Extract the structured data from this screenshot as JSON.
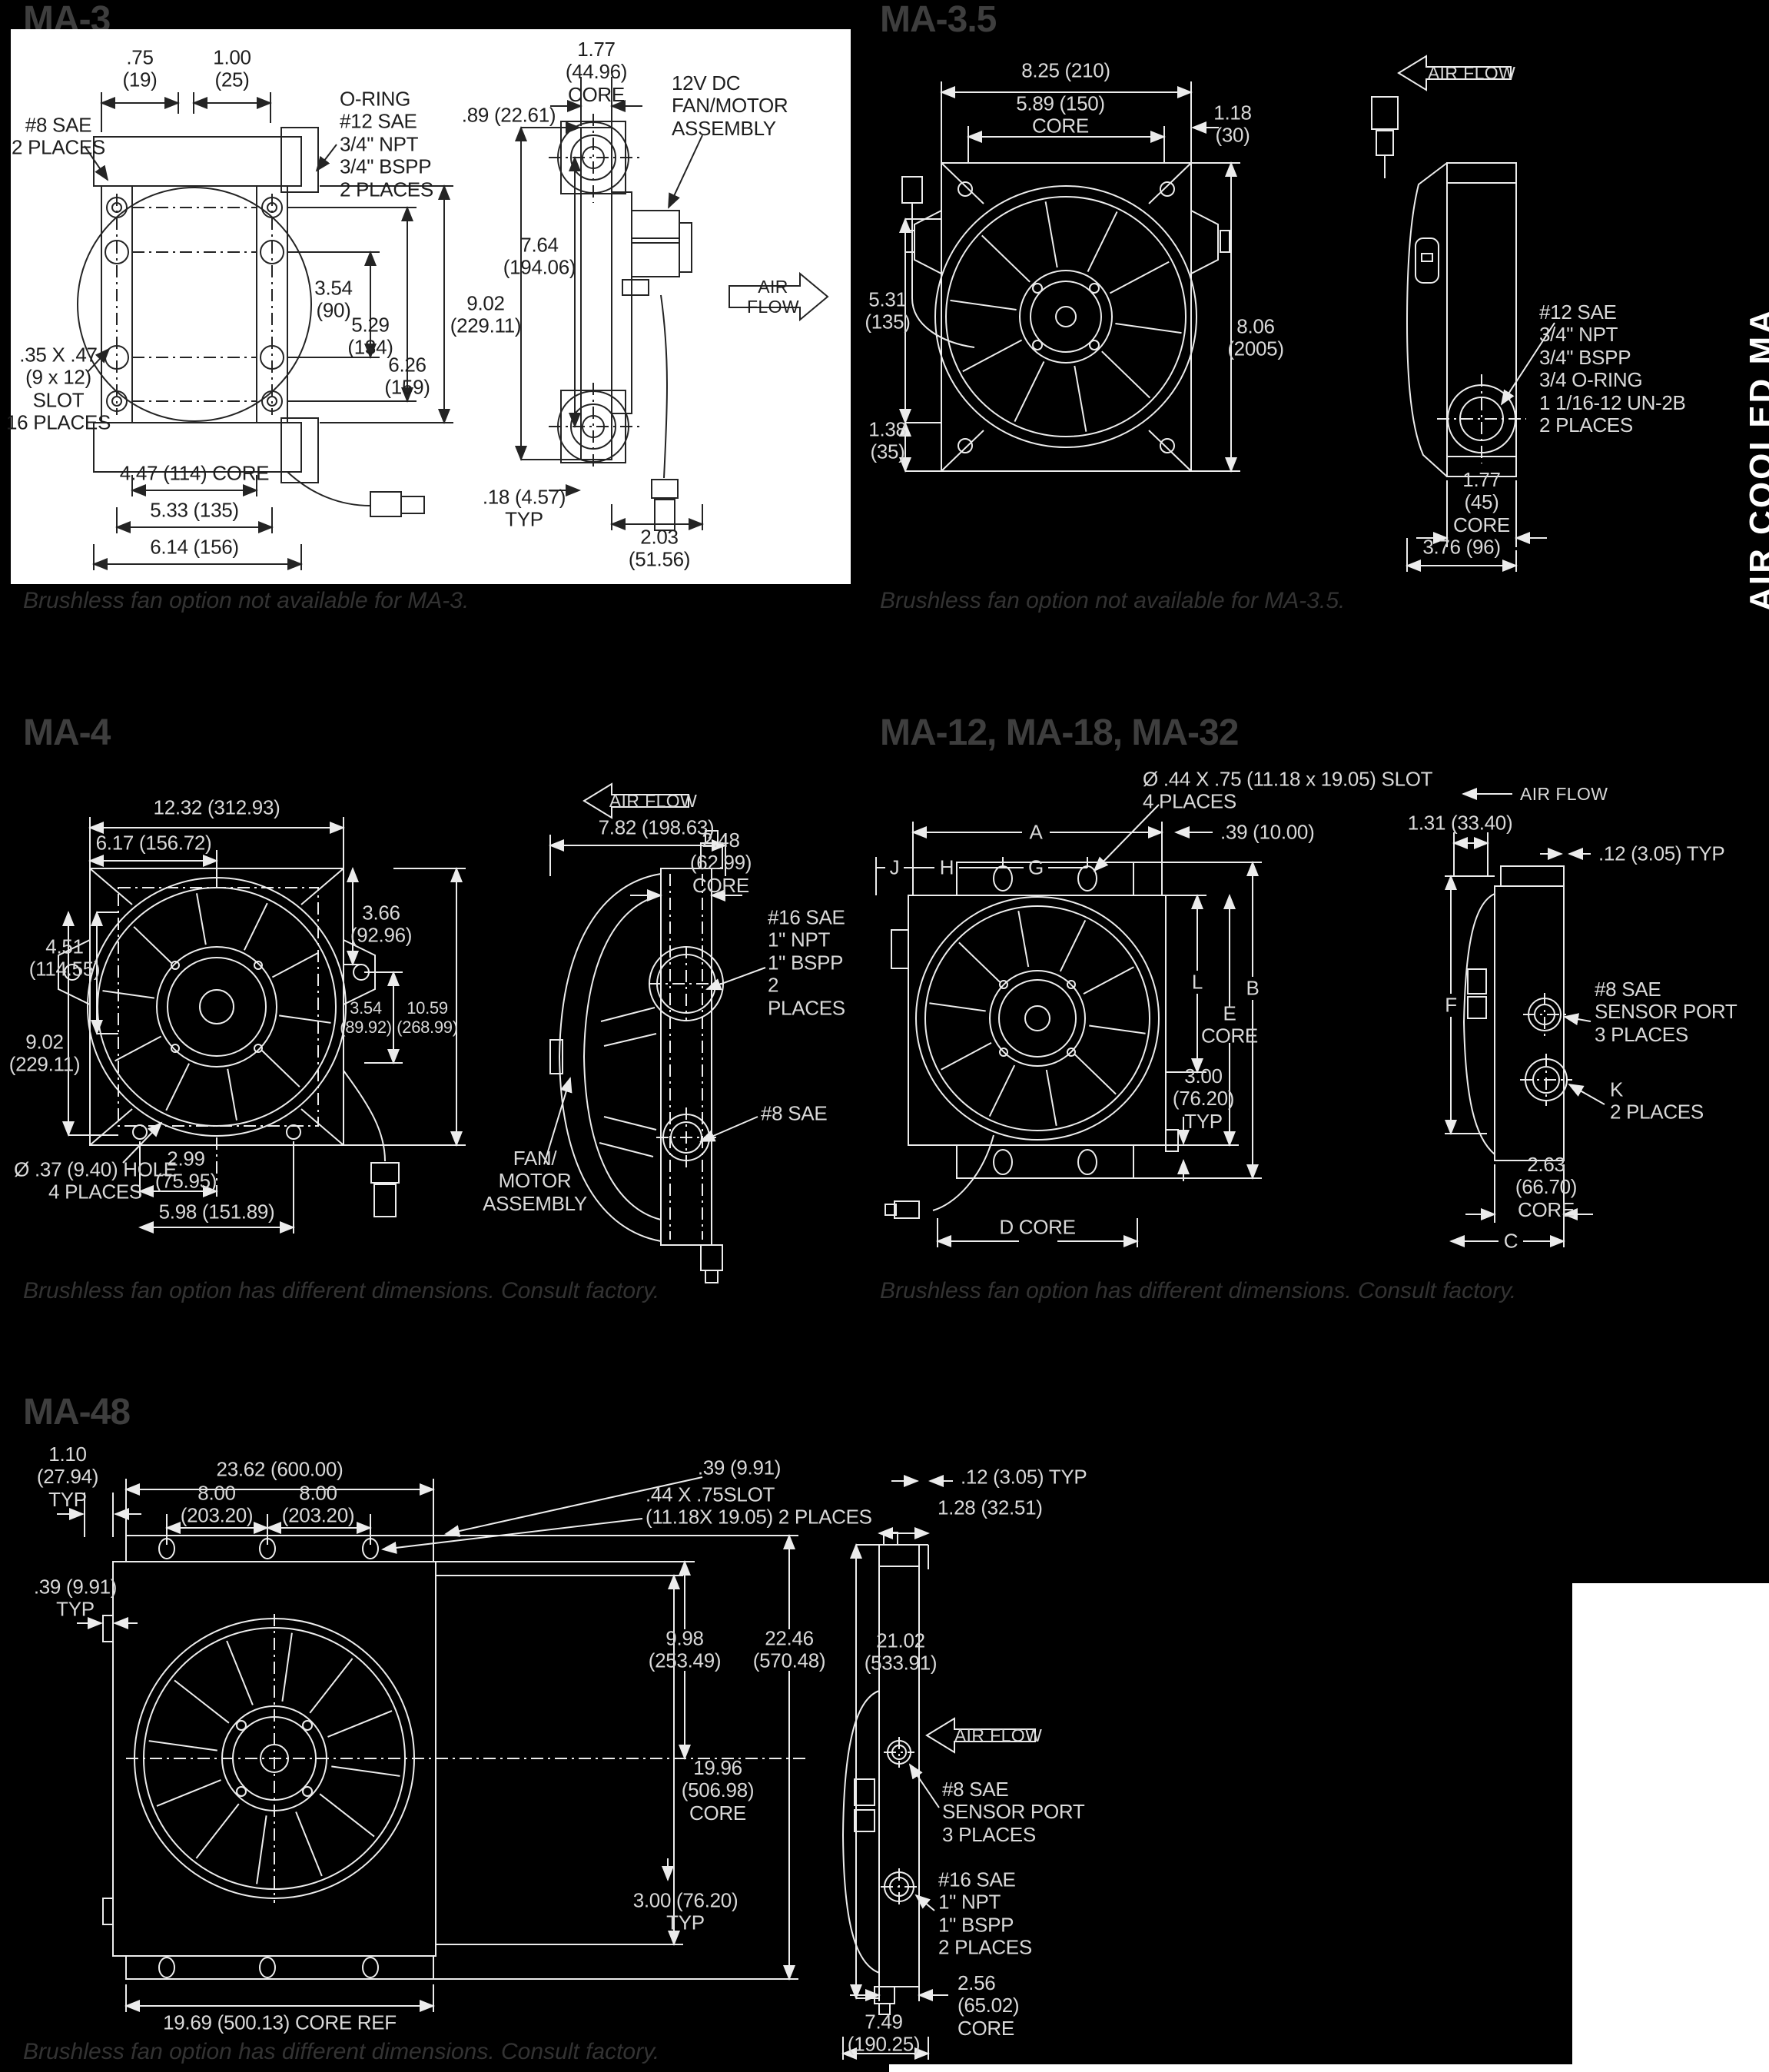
{
  "page": {
    "background": "#000000",
    "panel_white": "#ffffff",
    "line_light": "#ececec",
    "line_dark": "#242424",
    "sidebar_vertical_text": "AIR COOLED MA"
  },
  "ma3": {
    "title": "MA-3",
    "footnote": "Brushless fan option not available for MA-3.",
    "front": {
      "d75": ".75\n(19)",
      "d100": "1.00\n(25)",
      "sae8": "#8 SAE\n2 PLACES",
      "oring": "O-RING\n#12 SAE\n3/4\" NPT\n3/4\" BSPP\n2 PLACES",
      "d354": "3.54\n(90)",
      "d529": "5.29\n(134)",
      "d626": "6.26\n(159)",
      "slot": ".35 X .47\n(9 x 12)\nSLOT\n16 PLACES",
      "core447": "4.47 (114) CORE",
      "d533": "5.33 (135)",
      "d614": "6.14 (156)"
    },
    "side": {
      "core177": "1.77\n(44.96)\nCORE",
      "d089": ".89 (22.61)",
      "motor12v": "12V DC FAN/MOTOR\nASSEMBLY",
      "d764": "7.64\n(194.06)",
      "d902": "9.02\n(229.11)",
      "airflow": "AIR FLOW",
      "d018": ".18 (4.57)\nTYP",
      "d203": "2.03\n(51.56)"
    }
  },
  "ma35": {
    "title": "MA-3.5",
    "footnote": "Brushless fan option not available for MA-3.5.",
    "front": {
      "d825": "8.25 (210)",
      "core589": "5.89 (150)\nCORE",
      "d118": "1.18\n(30)",
      "d531": "5.31\n(135)",
      "d806": "8.06\n(2005)",
      "d138": "1.38\n(35)"
    },
    "side": {
      "airflow": "AIR FLOW",
      "ports": "#12 SAE\n3/4\" NPT\n3/4\" BSPP\n3/4 O-RING\n1 1/16-12 UN-2B\n2 PLACES",
      "core177": "1.77\n(45)\nCORE",
      "d376": "3.76 (96)"
    }
  },
  "ma4": {
    "title": "MA-4",
    "footnote": "Brushless fan option has different dimensions. Consult factory.",
    "front": {
      "d1232": "12.32 (312.93)",
      "d617": "6.17 (156.72)",
      "d366": "3.66\n(92.96)",
      "d451": "4.51\n(114.55)",
      "d902": "9.02\n(229.11)",
      "d354": "3.54\n(89.92)",
      "d1059": "10.59\n(268.99)",
      "hole": "Ø .37 (9.40) HOLE\n4 PLACES",
      "d299": "2.99\n(75.95)",
      "d598": "5.98 (151.89)"
    },
    "side": {
      "airflow": "AIR FLOW",
      "d782": "7.82 (198.63)",
      "core248": "2.48\n(62.99)\nCORE",
      "ports16": "#16 SAE\n1\" NPT\n1\" BSPP\n2 PLACES",
      "sae8": "#8 SAE",
      "fanmotor": "FAN/\nMOTOR\nASSEMBLY"
    }
  },
  "ma12": {
    "title": "MA-12, MA-18, MA-32",
    "footnote": "Brushless fan option has different dimensions. Consult factory.",
    "front": {
      "slot": "Ø .44 X .75 (11.18 x 19.05) SLOT\n4 PLACES",
      "d039": ".39  (10.00)",
      "A": "A",
      "G": "G",
      "H": "H",
      "J": "J",
      "L": "L",
      "Ecore": "E\nCORE",
      "B": "B",
      "d300": "3.00\n(76.20)\nTYP",
      "Dcore": "D CORE"
    },
    "side": {
      "airflow": "AIR FLOW",
      "d131": "1.31  (33.40)",
      "d012": ".12  (3.05) TYP",
      "F": "F",
      "sensor": "#8 SAE\nSENSOR PORT\n3 PLACES",
      "K": "K\n2 PLACES",
      "core263": "2.63\n(66.70)\nCORE",
      "C": "C"
    }
  },
  "ma48": {
    "title": "MA-48",
    "footnote": "Brushless fan option has different dimensions. Consult factory.",
    "front": {
      "d110": "1.10\n(27.94)\nTYP",
      "d2362": "23.62 (600.00)",
      "d800": "8.00\n(203.20)",
      "d039typ": ".39 (9.91)\nTYP",
      "d039": ".39 (9.91)",
      "slot": ".44 X .75SLOT\n(11.18X 19.05) 2 PLACES",
      "d998": "9.98\n(253.49)",
      "d2246": "22.46\n(570.48)",
      "core1996": "19.96\n(506.98)\nCORE",
      "d300": "3.00 (76.20)\nTYP",
      "coreref": "19.69 (500.13) CORE REF"
    },
    "side": {
      "d012": ".12 (3.05) TYP",
      "d128": "1.28 (32.51)",
      "d2102": "21.02\n(533.91)",
      "airflow": "AIR FLOW",
      "sensor": "#8 SAE\nSENSOR PORT\n3 PLACES",
      "ports16": "#16 SAE\n1\" NPT\n1\" BSPP\n2 PLACES",
      "core256": "2.56\n(65.02)\nCORE",
      "d749": "7.49\n(190.25)"
    }
  }
}
